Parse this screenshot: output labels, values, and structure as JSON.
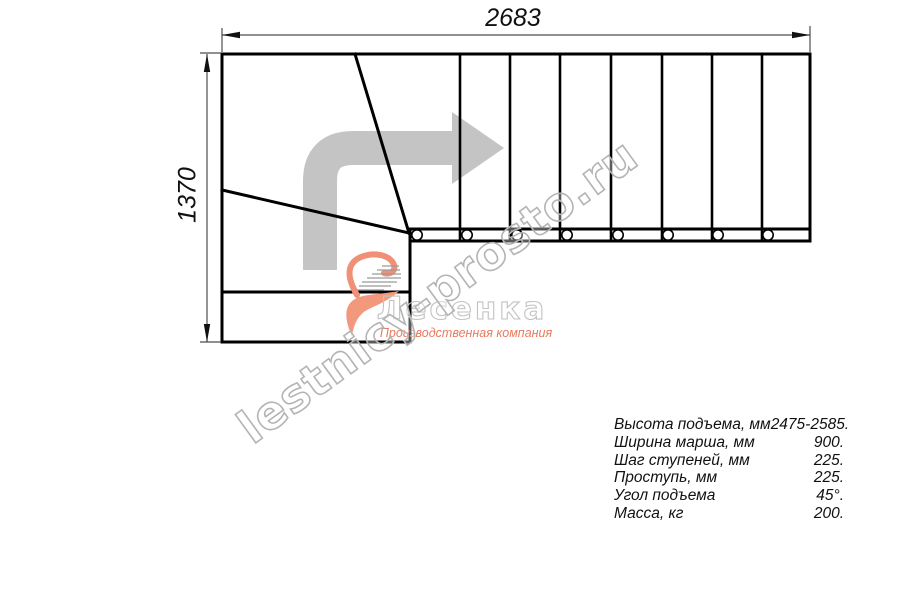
{
  "drawing": {
    "type": "staircase-plan-top-view",
    "dimensions": {
      "width_label": "2683",
      "height_label": "1370"
    },
    "direction_arrow_icon": "turn-up-then-right-arrow"
  },
  "watermark": {
    "text": "lestnicy-prosto.ru"
  },
  "logo": {
    "icon": "swoosh-heart-icon",
    "wordmark": "Лесенка",
    "tagline": "Производственная компания"
  },
  "specs": {
    "rows": [
      {
        "label": "Высота подъема, мм",
        "value": "2475-2585."
      },
      {
        "label": "Ширина марша, мм",
        "value": "900."
      },
      {
        "label": "Шаг ступеней, мм",
        "value": "225."
      },
      {
        "label": "Проступь, мм",
        "value": "225."
      },
      {
        "label": "Угол подъема",
        "value": "45°."
      },
      {
        "label": "Масса, кг",
        "value": "200."
      }
    ]
  },
  "colors": {
    "line_black": "#000000",
    "dimension_gray": "#4d4d4d",
    "arrow_gray": "#c4c4c4",
    "watermark_gray": "#b4b4b4",
    "logo_salmon": "#ef9077",
    "tagline_salmon": "#e87a5e"
  }
}
